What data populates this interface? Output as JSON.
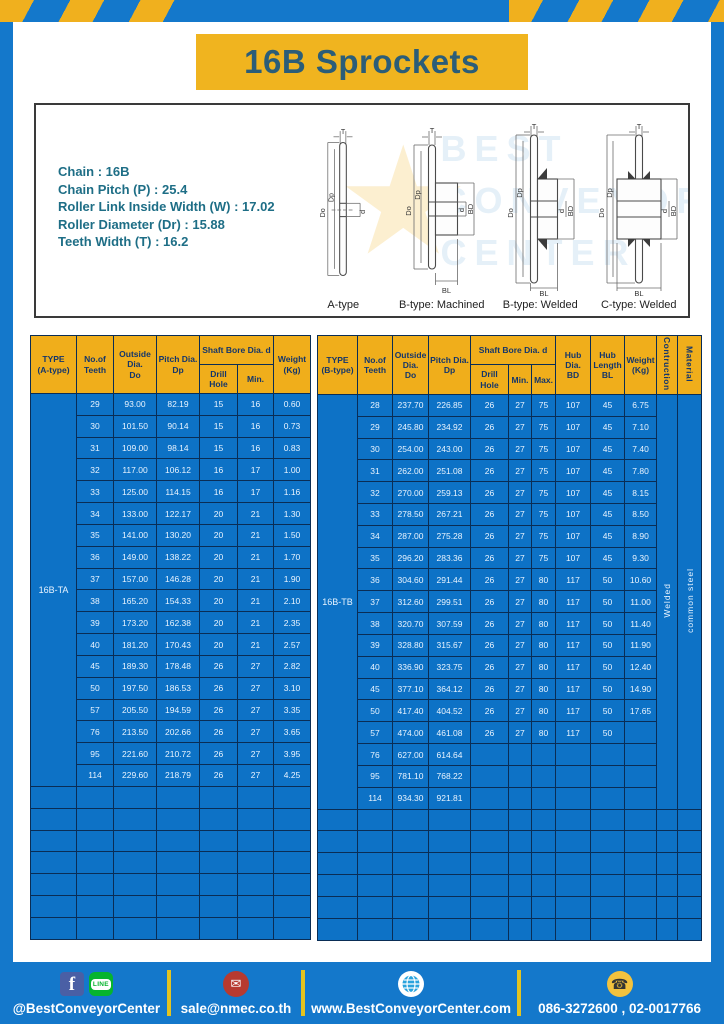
{
  "title": "16B Sprockets",
  "specs": [
    "Chain  :  16B",
    "Chain Pitch (P)  :  25.4",
    "Roller Link Inside Width (W)  :  17.02",
    "Roller Diameter (Dr)  : 15.88",
    "Teeth Width (T)  :  16.2"
  ],
  "watermark": {
    "star": "★",
    "text": "BEST\nCONVEYOR\nCENTER"
  },
  "diagrams": [
    {
      "caption": "A-type",
      "labels": {
        "t": "T",
        "do": "Do",
        "dp": "Dp",
        "d": "d"
      }
    },
    {
      "caption": "B-type: Machined",
      "labels": {
        "t": "T",
        "do": "Do",
        "dp": "Dp",
        "d": "d",
        "bd": "BD",
        "bl": "BL"
      }
    },
    {
      "caption": "B-type: Welded",
      "labels": {
        "t": "T",
        "do": "Do",
        "dp": "Dp",
        "d": "d",
        "bd": "BD",
        "bl": "BL"
      }
    },
    {
      "caption": "C-type: Welded",
      "labels": {
        "t": "T",
        "do": "Do",
        "dp": "Dp",
        "d": "d",
        "bd": "BD",
        "bl": "BL"
      }
    }
  ],
  "table_a": {
    "header": {
      "type": "TYPE\n(A-type)",
      "teeth": "No.of\nTeeth",
      "outside_dia": "Outside\nDia.\nDo",
      "pitch_dia": "Pitch Dia.\nDp",
      "shaft_bore": "Shaft Bore Dia. d",
      "drill_hole": "Drill Hole",
      "min": "Min.",
      "weight": "Weight\n(Kg)"
    },
    "type_label": "16B-TA",
    "rows": [
      [
        "29",
        "93.00",
        "82.19",
        "15",
        "16",
        "0.60"
      ],
      [
        "30",
        "101.50",
        "90.14",
        "15",
        "16",
        "0.73"
      ],
      [
        "31",
        "109.00",
        "98.14",
        "15",
        "16",
        "0.83"
      ],
      [
        "32",
        "117.00",
        "106.12",
        "16",
        "17",
        "1.00"
      ],
      [
        "33",
        "125.00",
        "114.15",
        "16",
        "17",
        "1.16"
      ],
      [
        "34",
        "133.00",
        "122.17",
        "20",
        "21",
        "1.30"
      ],
      [
        "35",
        "141.00",
        "130.20",
        "20",
        "21",
        "1.50"
      ],
      [
        "36",
        "149.00",
        "138.22",
        "20",
        "21",
        "1.70"
      ],
      [
        "37",
        "157.00",
        "146.28",
        "20",
        "21",
        "1.90"
      ],
      [
        "38",
        "165.20",
        "154.33",
        "20",
        "21",
        "2.10"
      ],
      [
        "39",
        "173.20",
        "162.38",
        "20",
        "21",
        "2.35"
      ],
      [
        "40",
        "181.20",
        "170.43",
        "20",
        "21",
        "2.57"
      ],
      [
        "45",
        "189.30",
        "178.48",
        "26",
        "27",
        "2.82"
      ],
      [
        "50",
        "197.50",
        "186.53",
        "26",
        "27",
        "3.10"
      ],
      [
        "57",
        "205.50",
        "194.59",
        "26",
        "27",
        "3.35"
      ],
      [
        "76",
        "213.50",
        "202.66",
        "26",
        "27",
        "3.65"
      ],
      [
        "95",
        "221.60",
        "210.72",
        "26",
        "27",
        "3.95"
      ],
      [
        "114",
        "229.60",
        "218.79",
        "26",
        "27",
        "4.25"
      ]
    ],
    "empty_row_count": 7
  },
  "table_b": {
    "header": {
      "type": "TYPE\n(B-type)",
      "teeth": "No.of\nTeeth",
      "outside_dia": "Outside\nDia.\nDo",
      "pitch_dia": "Pitch Dia.\nDp",
      "shaft_bore": "Shaft Bore Dia. d",
      "drill_hole": "Drill Hole",
      "min": "Min.",
      "max": "Max.",
      "hub_dia": "Hub Dia.\nBD",
      "hub_length": "Hub\nLength\nBL",
      "weight": "Weight\n(Kg)",
      "construction": "Contruction",
      "material": "Material"
    },
    "type_label": "16B-TB",
    "construction_value": "Welded",
    "material_value": "common steel",
    "rows": [
      [
        "28",
        "237.70",
        "226.85",
        "26",
        "27",
        "75",
        "107",
        "45",
        "6.75"
      ],
      [
        "29",
        "245.80",
        "234.92",
        "26",
        "27",
        "75",
        "107",
        "45",
        "7.10"
      ],
      [
        "30",
        "254.00",
        "243.00",
        "26",
        "27",
        "75",
        "107",
        "45",
        "7.40"
      ],
      [
        "31",
        "262.00",
        "251.08",
        "26",
        "27",
        "75",
        "107",
        "45",
        "7.80"
      ],
      [
        "32",
        "270.00",
        "259.13",
        "26",
        "27",
        "75",
        "107",
        "45",
        "8.15"
      ],
      [
        "33",
        "278.50",
        "267.21",
        "26",
        "27",
        "75",
        "107",
        "45",
        "8.50"
      ],
      [
        "34",
        "287.00",
        "275.28",
        "26",
        "27",
        "75",
        "107",
        "45",
        "8.90"
      ],
      [
        "35",
        "296.20",
        "283.36",
        "26",
        "27",
        "75",
        "107",
        "45",
        "9.30"
      ],
      [
        "36",
        "304.60",
        "291.44",
        "26",
        "27",
        "80",
        "117",
        "50",
        "10.60"
      ],
      [
        "37",
        "312.60",
        "299.51",
        "26",
        "27",
        "80",
        "117",
        "50",
        "11.00"
      ],
      [
        "38",
        "320.70",
        "307.59",
        "26",
        "27",
        "80",
        "117",
        "50",
        "11.40"
      ],
      [
        "39",
        "328.80",
        "315.67",
        "26",
        "27",
        "80",
        "117",
        "50",
        "11.90"
      ],
      [
        "40",
        "336.90",
        "323.75",
        "26",
        "27",
        "80",
        "117",
        "50",
        "12.40"
      ],
      [
        "45",
        "377.10",
        "364.12",
        "26",
        "27",
        "80",
        "117",
        "50",
        "14.90"
      ],
      [
        "50",
        "417.40",
        "404.52",
        "26",
        "27",
        "80",
        "117",
        "50",
        "17.65"
      ],
      [
        "57",
        "474.00",
        "461.08",
        "26",
        "27",
        "80",
        "117",
        "50",
        ""
      ],
      [
        "76",
        "627.00",
        "614.64",
        "",
        "",
        "",
        "",
        "",
        ""
      ],
      [
        "95",
        "781.10",
        "768.22",
        "",
        "",
        "",
        "",
        "",
        ""
      ],
      [
        "114",
        "934.30",
        "921.81",
        "",
        "",
        "",
        "",
        "",
        ""
      ]
    ],
    "empty_row_count": 6
  },
  "footer": {
    "social_label": "@BestConveyorCenter",
    "email": "sale@nmec.co.th",
    "website": "www.BestConveyorCenter.com",
    "phones": "086-3272600 , 02-0017766",
    "facebook_glyph": "f",
    "line_glyph": "LINE",
    "email_glyph": "✉",
    "phone_glyph": "☎"
  }
}
